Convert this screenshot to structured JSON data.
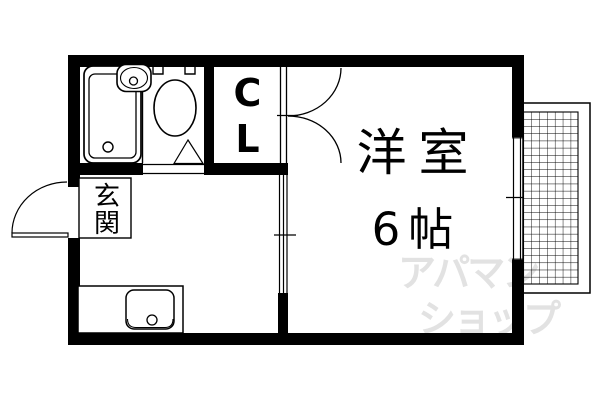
{
  "plan": {
    "background": "#ffffff",
    "wall_color": "#000000",
    "line_color": "#000000"
  },
  "rooms": {
    "western_room": {
      "label": "洋室",
      "size": "6帖"
    },
    "closet": {
      "label": "CL"
    },
    "entrance": {
      "label": "玄関"
    }
  },
  "watermark": {
    "line1": "アパマン",
    "line2": "ショップ",
    "color": "#e2e2e2"
  },
  "fixtures": [
    "bathtub",
    "washbasin",
    "toilet",
    "bathroom-door-triangle",
    "kitchen-sink-counter",
    "entrance-swing-door",
    "closet-double-doors",
    "sliding-door",
    "window",
    "balcony-grid"
  ]
}
